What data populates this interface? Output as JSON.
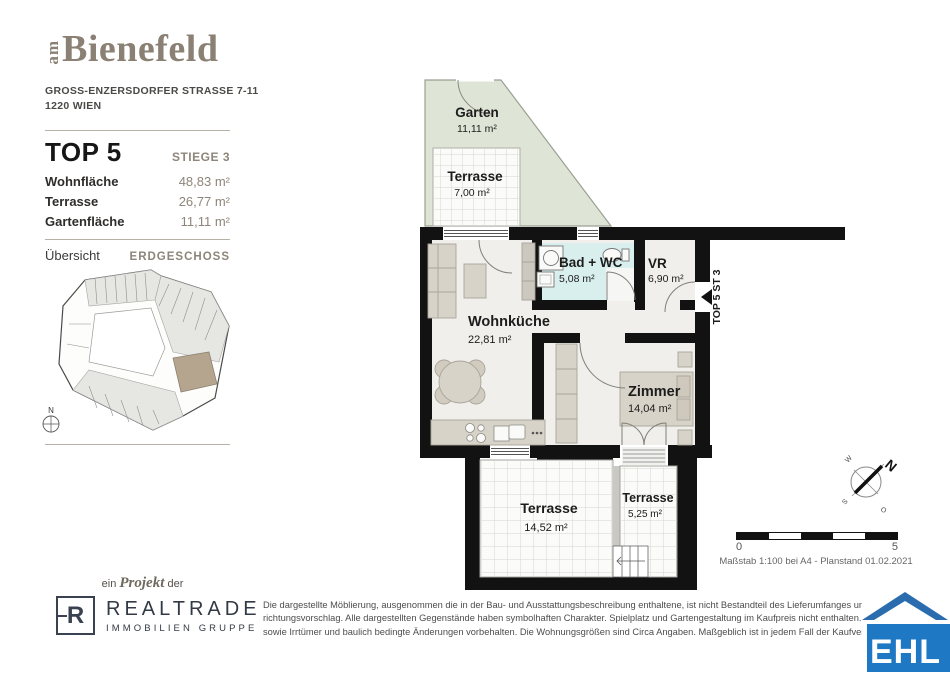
{
  "brand": {
    "prefix": "am",
    "name": "Bienefeld",
    "address_line1": "GROSS-ENZERSDORFER STRASSE 7-11",
    "address_line2": "1220 WIEN"
  },
  "unit": {
    "title": "TOP 5",
    "stiege": "STIEGE 3",
    "areas": [
      {
        "label": "Wohnfläche",
        "value": "48,83 m²"
      },
      {
        "label": "Terrasse",
        "value": "26,77 m²"
      },
      {
        "label": "Gartenfläche",
        "value": "11,11 m²"
      }
    ]
  },
  "overview": {
    "label": "Übersicht",
    "level": "ERDGESCHOSS",
    "compass_n": "N"
  },
  "floorplan": {
    "entrance_label": "TOP 5 ST 3",
    "rooms": [
      {
        "name": "Garten",
        "area": "11,11 m²"
      },
      {
        "name": "Terrasse",
        "area": "7,00 m²"
      },
      {
        "name": "Bad + WC",
        "area": "5,08 m²"
      },
      {
        "name": "VR",
        "area": "6,90 m²"
      },
      {
        "name": "Wohnküche",
        "area": "22,81 m²"
      },
      {
        "name": "Zimmer",
        "area": "14,04 m²"
      },
      {
        "name": "Terrasse",
        "area": "14,52 m²"
      },
      {
        "name": "Terrasse",
        "area": "5,25 m²"
      }
    ],
    "compass": {
      "n": "N",
      "w": "W",
      "s": "S",
      "o": "O"
    }
  },
  "scalebar": {
    "start": "0",
    "end": "5",
    "caption": "Maßstab 1:100 bei A4 - Planstand 01.02.2021"
  },
  "footer": {
    "project_line": {
      "pre": "ein",
      "word": "Projekt",
      "post": "der"
    },
    "realtrade": {
      "mark": "R",
      "name": "REALTRADE",
      "subtitle": "IMMOBILIEN GRUPPE"
    },
    "disclaimer": [
      "Die dargestellte Möblierung, ausgenommen die in der Bau- und Ausstattungsbeschreibung enthaltene, ist nicht Bestandteil des Lieferumfanges und dient nur als",
      "richtungsvorschlag. Alle dargestellten Gegenstände haben symbolhaften Charakter. Spielplatz und Gartengestaltung im Kaufpreis nicht enthalten. Druck- und Sa",
      "sowie Irrtümer und baulich bedingte Änderungen vorbehalten. Die Wohnungsgrößen sind Circa Angaben. Maßgeblich ist in jedem Fall der Kaufvertrag."
    ],
    "ehl": "EHL"
  },
  "colors": {
    "accent_taupe": "#8d8579",
    "wall": "#121212",
    "garden": "#dfe5d6",
    "bath": "#d9efee",
    "furniture": "#d8d3c8",
    "ehl_blue": "#1e78c4",
    "highlight_unit": "#b5a48e"
  }
}
